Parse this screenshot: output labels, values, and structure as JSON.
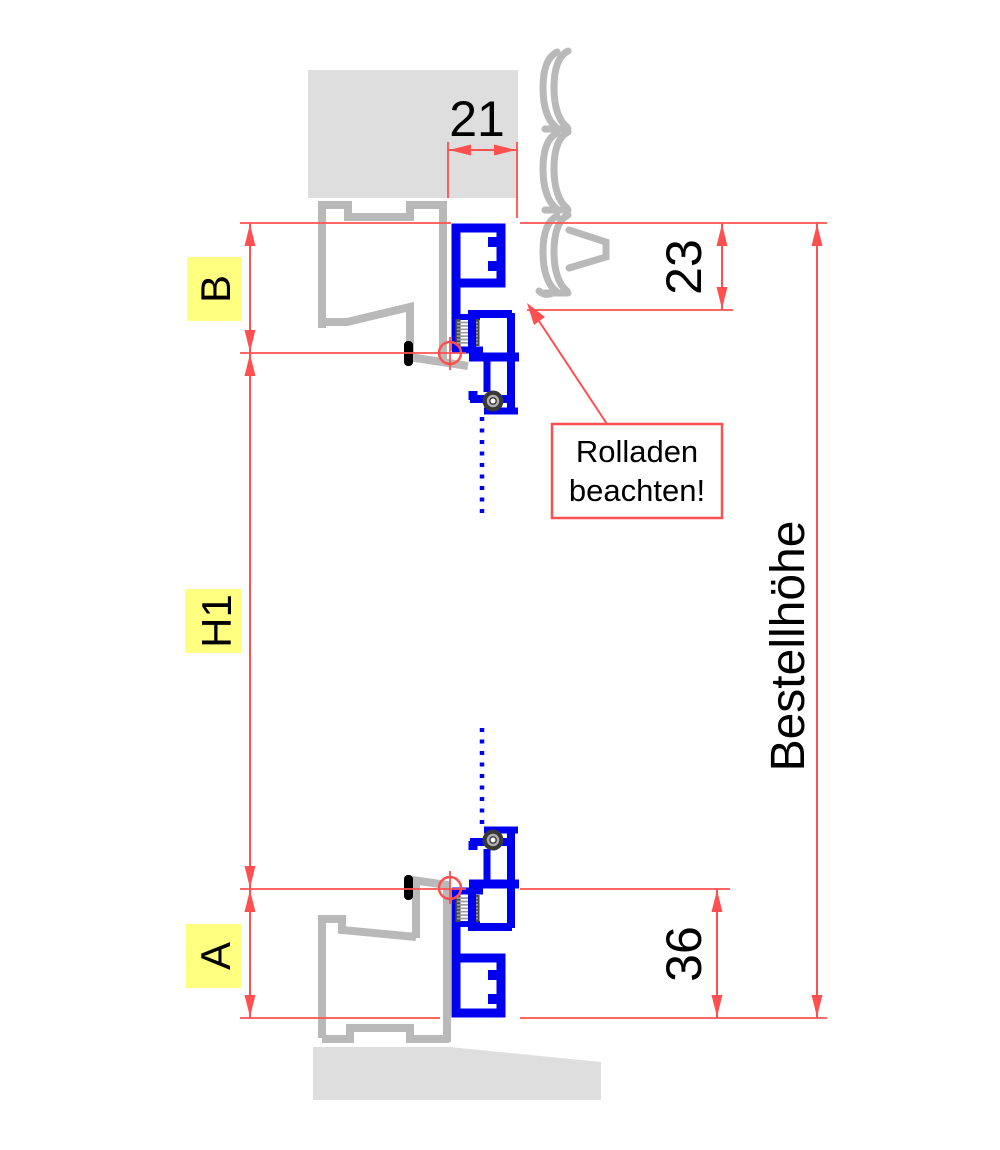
{
  "drawing_type": "window-fly-screen-installation-cross-section",
  "dimensions": {
    "overlap_width": "21",
    "top_profile_height": "23",
    "bottom_profile_height": "36",
    "order_height": "Bestellhöhe"
  },
  "measure_labels": {
    "top": "B",
    "middle": "H1",
    "bottom": "A"
  },
  "annotation": {
    "line1": "Rolladen",
    "line2": "beachten!"
  },
  "colors": {
    "profile_blue": "#0000f0",
    "dimension_red": "#ff5050",
    "frame_gray": "#b9b9b9",
    "masonry_gray": "#dedede",
    "highlight_yellow": "#ffff80",
    "text_black": "#000000"
  }
}
